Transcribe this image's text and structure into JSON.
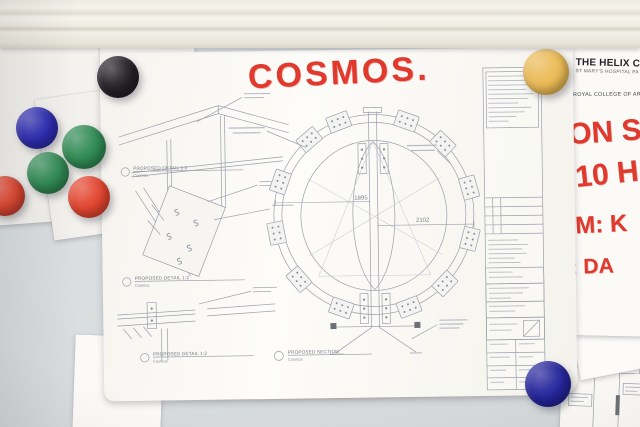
{
  "photo": {
    "description": "Architectural drawings for the Cosmos sculpture pinned to a whiteboard with coloured round magnets"
  },
  "colors": {
    "marker_red": "#e03a2f",
    "ink": "#9aa0ab",
    "board": "#d9dcde"
  },
  "magnets": {
    "black": "#232026",
    "blue": "#2b2ab2",
    "green_a": "#2f8a53",
    "green_b": "#2f8a53",
    "red_a": "#e2442e",
    "red_b": "#e2442e",
    "yellow": "#eaba55",
    "navy": "#24249a"
  },
  "main_sheet": {
    "handwritten_title": "COSMOS.",
    "details": [
      {
        "label": "PROPOSED DETAIL 1:2",
        "sublabel": "Cosmos"
      },
      {
        "label": "PROPOSED DETAIL 1:2",
        "sublabel": "Cosmos"
      },
      {
        "label": "PROPOSED DETAIL 1:2",
        "sublabel": "Cosmos"
      }
    ],
    "section": {
      "label": "PROPOSED SECTION",
      "sublabel": "Cosmos"
    },
    "dim_left": "1895",
    "dim_right": "2102"
  },
  "right_sheet": {
    "header1": "THE HELIX C",
    "header2": "ST MARY'S HOSPITAL PA",
    "header3": "ROYAL COLLEGE OF AR",
    "note1": "ON S",
    "note2": "10 H",
    "note3": "PM: K",
    "note4": "D: DA"
  },
  "plan_sheet": {
    "tag1": "DOOR",
    "tag2": "SHUTTE",
    "tag3": "HD-08"
  }
}
